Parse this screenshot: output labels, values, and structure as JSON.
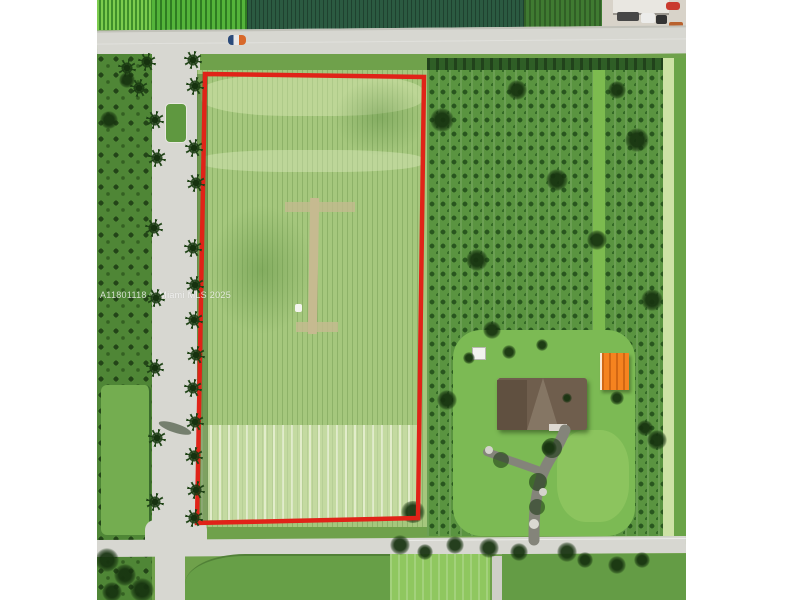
{
  "photo": {
    "watermark": "A11801118 © Miami MLS 2025"
  },
  "colors": {
    "boundary_red": "#e02318",
    "shed_orange_roof": "#f5831f",
    "road_gray": "#d7d7d1",
    "field_green": "#a5c77d",
    "orchard_green": "#5a9440",
    "lawn_green": "#7cba54",
    "house_roof_brown": "#6f5e4d",
    "margin_white": "#ffffff"
  }
}
